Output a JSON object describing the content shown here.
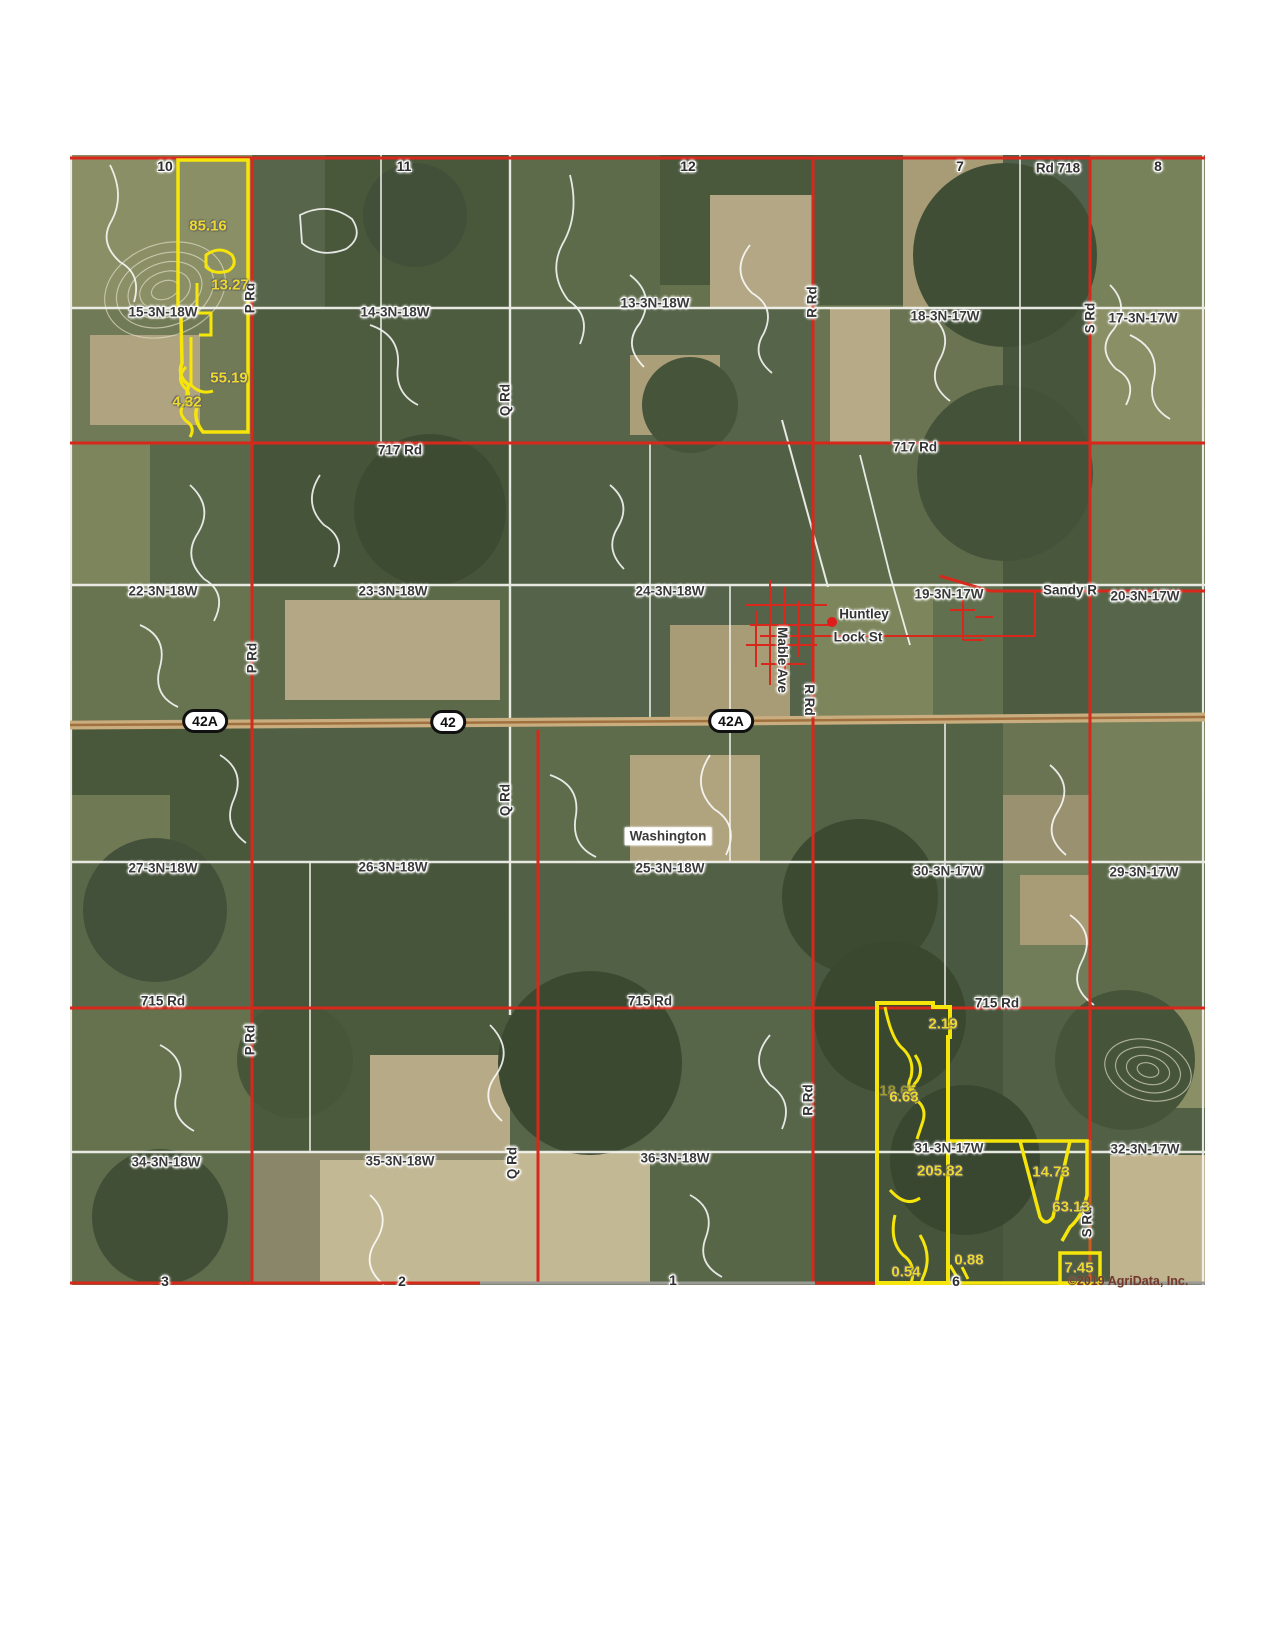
{
  "map": {
    "copyright": "©2019 AgriData, Inc.",
    "town": "Huntley",
    "town_boxed": "Washington"
  },
  "colors": {
    "road_red": "#d8281c",
    "road_orange": "#cc5a1f",
    "highway_tan": "#c9ad7e",
    "parcel_yellow": "#f6e50a",
    "boundary_white": "#ffffff",
    "label_dark": "#3a3a3a",
    "acres_yellow": "#ecd92f"
  },
  "sections": [
    {
      "text": "15-3N-18W",
      "x": 93,
      "y": 157
    },
    {
      "text": "14-3N-18W",
      "x": 325,
      "y": 157
    },
    {
      "text": "13-3N-18W",
      "x": 585,
      "y": 148
    },
    {
      "text": "18-3N-17W",
      "x": 875,
      "y": 161
    },
    {
      "text": "17-3N-17W",
      "x": 1073,
      "y": 163
    },
    {
      "text": "22-3N-18W",
      "x": 93,
      "y": 436
    },
    {
      "text": "23-3N-18W",
      "x": 323,
      "y": 436
    },
    {
      "text": "24-3N-18W",
      "x": 600,
      "y": 436
    },
    {
      "text": "19-3N-17W",
      "x": 879,
      "y": 439
    },
    {
      "text": "20-3N-17W",
      "x": 1075,
      "y": 441
    },
    {
      "text": "27-3N-18W",
      "x": 93,
      "y": 713
    },
    {
      "text": "26-3N-18W",
      "x": 323,
      "y": 712
    },
    {
      "text": "25-3N-18W",
      "x": 600,
      "y": 713
    },
    {
      "text": "30-3N-17W",
      "x": 878,
      "y": 716
    },
    {
      "text": "29-3N-17W",
      "x": 1074,
      "y": 717
    },
    {
      "text": "34-3N-18W",
      "x": 96,
      "y": 1007
    },
    {
      "text": "35-3N-18W",
      "x": 330,
      "y": 1006
    },
    {
      "text": "36-3N-18W",
      "x": 605,
      "y": 1003
    },
    {
      "text": "31-3N-17W",
      "x": 879,
      "y": 993
    },
    {
      "text": "32-3N-17W",
      "x": 1075,
      "y": 994
    }
  ],
  "roads_h": [
    {
      "text": "Rd 718",
      "x": 988,
      "y": 13
    },
    {
      "text": "717 Rd",
      "x": 330,
      "y": 295
    },
    {
      "text": "717 Rd",
      "x": 845,
      "y": 292
    },
    {
      "text": "715 Rd",
      "x": 93,
      "y": 846
    },
    {
      "text": "715 Rd",
      "x": 580,
      "y": 846
    },
    {
      "text": "715 Rd",
      "x": 927,
      "y": 848
    },
    {
      "text": "Sandy R",
      "x": 1000,
      "y": 435
    },
    {
      "text": "Lock St",
      "x": 788,
      "y": 482
    }
  ],
  "roads_v": [
    {
      "text": "P Rd",
      "x": 180,
      "y": 143,
      "rot": -90
    },
    {
      "text": "P Rd",
      "x": 182,
      "y": 503,
      "rot": -90
    },
    {
      "text": "P Rd",
      "x": 180,
      "y": 885,
      "rot": -90
    },
    {
      "text": "Q Rd",
      "x": 435,
      "y": 245,
      "rot": -90
    },
    {
      "text": "Q Rd",
      "x": 435,
      "y": 645,
      "rot": -90
    },
    {
      "text": "Q Rd",
      "x": 442,
      "y": 1008,
      "rot": -90
    },
    {
      "text": "R Rd",
      "x": 742,
      "y": 147,
      "rot": -90
    },
    {
      "text": "R Rd",
      "x": 739,
      "y": 545,
      "rot": 90
    },
    {
      "text": "R Rd",
      "x": 738,
      "y": 945,
      "rot": -90
    },
    {
      "text": "S Rd",
      "x": 1020,
      "y": 163,
      "rot": -90
    },
    {
      "text": "S Rd",
      "x": 1017,
      "y": 1067,
      "rot": -90
    },
    {
      "text": "Mable Ave",
      "x": 712,
      "y": 505,
      "rot": 90
    }
  ],
  "numbers": [
    {
      "text": "10",
      "x": 95,
      "y": 11
    },
    {
      "text": "11",
      "x": 334,
      "y": 11
    },
    {
      "text": "12",
      "x": 618,
      "y": 11
    },
    {
      "text": "7",
      "x": 890,
      "y": 11
    },
    {
      "text": "8",
      "x": 1088,
      "y": 11
    },
    {
      "text": "3",
      "x": 95,
      "y": 1126
    },
    {
      "text": "2",
      "x": 332,
      "y": 1126
    },
    {
      "text": "1",
      "x": 603,
      "y": 1125
    },
    {
      "text": "6",
      "x": 886,
      "y": 1126
    }
  ],
  "acres": [
    {
      "text": "85.16",
      "x": 138,
      "y": 71
    },
    {
      "text": "13.27",
      "x": 160,
      "y": 130
    },
    {
      "text": "55.19",
      "x": 159,
      "y": 223
    },
    {
      "text": "4.32",
      "x": 117,
      "y": 247
    },
    {
      "text": "2.19",
      "x": 873,
      "y": 869
    },
    {
      "text": "18.65",
      "x": 828,
      "y": 936,
      "dim": true
    },
    {
      "text": "6.63",
      "x": 834,
      "y": 942
    },
    {
      "text": "205.82",
      "x": 870,
      "y": 1016
    },
    {
      "text": "14.73",
      "x": 981,
      "y": 1017
    },
    {
      "text": "63.13",
      "x": 1001,
      "y": 1052
    },
    {
      "text": "0.54",
      "x": 836,
      "y": 1117
    },
    {
      "text": "0.88",
      "x": 899,
      "y": 1105
    },
    {
      "text": "7.45",
      "x": 1009,
      "y": 1113
    }
  ],
  "shields": [
    {
      "text": "42A",
      "x": 135,
      "y": 566
    },
    {
      "text": "42",
      "x": 378,
      "y": 567
    },
    {
      "text": "42A",
      "x": 661,
      "y": 566
    }
  ],
  "towns": [
    {
      "text": "Huntley",
      "x": 794,
      "y": 459
    }
  ],
  "towns_boxed": [
    {
      "text": "Washington",
      "x": 598,
      "y": 681
    }
  ]
}
